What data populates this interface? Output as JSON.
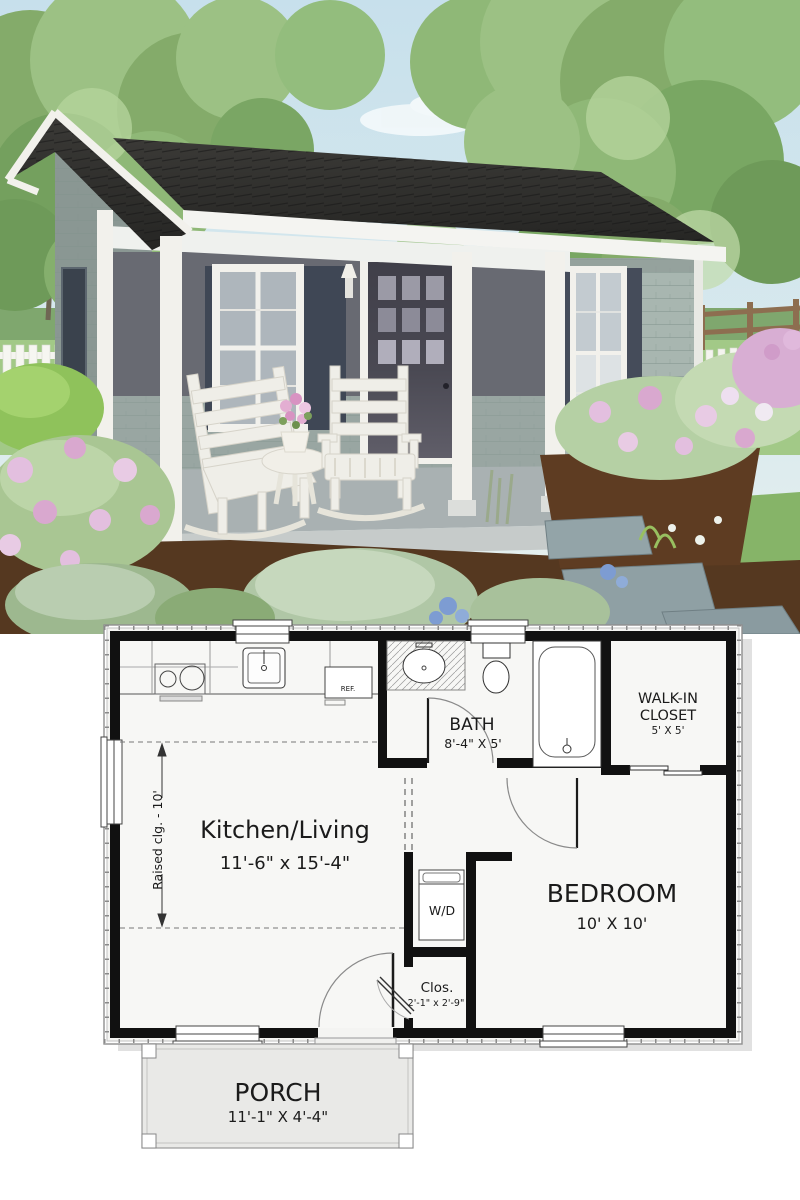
{
  "meta": {
    "title": "Tiny cottage – exterior rendering and floor plan"
  },
  "rendering": {
    "alt": "3D rendering of a small gray shingle cottage with gabled front porch, two white rocking chairs, side table with pink flowers, and flower gardens",
    "colors": {
      "sky": "#cfe3ec",
      "foliage": "#8fb474",
      "roof": "#333231",
      "trim": "#f2f1ec",
      "siding": "#a8b6b0",
      "siding_shade": "#8a9793",
      "porch_shadow_wall": "#686a72",
      "door": "#4a4953",
      "shutters": "#454c5a",
      "porch_floor": "#a9b1b2",
      "mulch": "#553820",
      "lawn": "#92bd75",
      "flowers_pink": "#ddb7d8",
      "flowers_blue": "#7d9cd2",
      "stones": "#93a4a8"
    }
  },
  "floor_plan": {
    "rooms": [
      {
        "id": "kitchen_living",
        "name": "Kitchen/Living",
        "dims": "11'-6\" x 15'-4\""
      },
      {
        "id": "bath",
        "name": "BATH",
        "dims": "8'-4\" X 5'"
      },
      {
        "id": "walk_in_closet",
        "name_line1": "WALK-IN",
        "name_line2": "CLOSET",
        "dims": "5' X 5'"
      },
      {
        "id": "bedroom",
        "name": "BEDROOM",
        "dims": "10' X 10'"
      },
      {
        "id": "closet",
        "name": "Clos.",
        "dims": "2'-1\" x 2'-9\""
      },
      {
        "id": "porch",
        "name": "PORCH",
        "dims": "11'-1\" X 4'-4\""
      }
    ],
    "annotations": {
      "washer_dryer": "W/D",
      "refrigerator": "REF.",
      "raised_ceiling": "Raised clg. - 10'"
    }
  }
}
